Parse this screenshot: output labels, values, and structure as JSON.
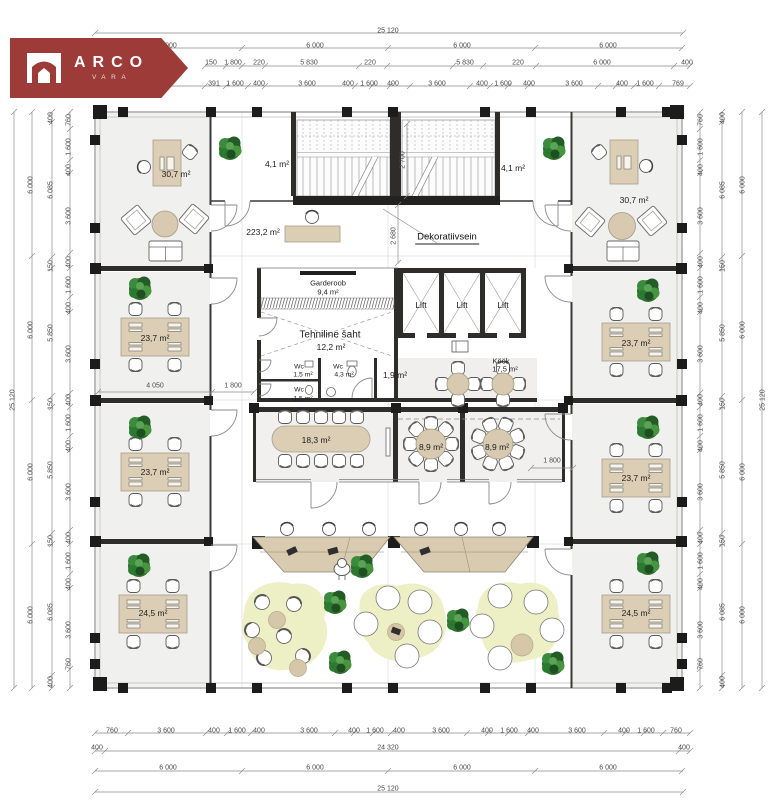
{
  "logo": {
    "brand": "ARCO",
    "sub": "VARA",
    "bg": "#9d3b38"
  },
  "rooms": {
    "office_tl": "30,7 m²",
    "office_tr": "30,7 m²",
    "vest_l": "4,1 m²",
    "vest_r": "4,1 m²",
    "open": "223,2 m²",
    "garderoob_name": "Garderoob",
    "garderoob_area": "9,4 m²",
    "shaft_name": "Tehniline šaht",
    "shaft_area": "12,2 m²",
    "lift": "Lift",
    "wc_name": "Wc",
    "wc1_area": "1,5 m²",
    "wc2_area": "1,5 m²",
    "wc3_area": "4,3 m²",
    "hall_area": "1,9 m²",
    "kitchen_name": "Köök",
    "kitchen_area": "17,5 m²",
    "decor": "Dekoratiivsein",
    "meeting_l": "18,3 m²",
    "meeting_m": "8,9 m²",
    "meeting_r": "8,9 m²",
    "office_l1": "23,7 m²",
    "office_l2": "23,7 m²",
    "office_l3": "24,5 m²",
    "office_r1": "23,7 m²",
    "office_r2": "23,7 m²",
    "office_r3": "24,5 m²"
  },
  "dims": {
    "top_total": "25 120",
    "top_bays": [
      "6 000",
      "6 000",
      "6 000",
      "6 000"
    ],
    "top_r3": [
      "150",
      "1 800",
      "220",
      "5 830",
      "220",
      "5 830",
      "220",
      "6 000",
      "400"
    ],
    "top_r4": [
      "391",
      "1 600",
      "400",
      "3 600",
      "400",
      "1 600",
      "400",
      "3 600",
      "400",
      "1 600",
      "400",
      "3 600",
      "400",
      "1 600",
      "769"
    ],
    "bottom_r1": [
      "760",
      "3 600",
      "400",
      "1 600",
      "400",
      "3 600",
      "400",
      "1 600",
      "400",
      "3 600",
      "400",
      "1 600",
      "400",
      "3 600",
      "400",
      "1 600",
      "760"
    ],
    "bottom_r2": [
      "400",
      "24 320",
      "400"
    ],
    "bottom_bays": [
      "6 000",
      "6 000",
      "6 000",
      "6 000"
    ],
    "bottom_total": "25 120",
    "left_total": "25 120",
    "left_bays": [
      "6 000",
      "6 000",
      "6 000",
      "6 000"
    ],
    "left_r3": [
      "400",
      "6 085",
      "150",
      "5 850",
      "150",
      "5 850",
      "150",
      "6 085",
      "400"
    ],
    "left_r4": [
      "760",
      "1 600",
      "400",
      "3 600",
      "400",
      "1 600",
      "400",
      "3 600",
      "400",
      "1 600",
      "400",
      "3 600",
      "400",
      "1 600",
      "400",
      "3 600",
      "760"
    ],
    "right_r4": [
      "760",
      "1 600",
      "400",
      "3 600",
      "400",
      "1 600",
      "400",
      "3 600",
      "400",
      "1 600",
      "400",
      "3 600",
      "400",
      "1 600",
      "400",
      "3 600",
      "760"
    ],
    "right_r3": [
      "400",
      "6 085",
      "150",
      "5 850",
      "150",
      "5 850",
      "150",
      "6 085",
      "400"
    ],
    "right_bays": [
      "6 000",
      "6 000",
      "6 000",
      "6 000"
    ],
    "right_total": "25 120",
    "int_corridor_a": "4 050",
    "int_corridor_b": "1 800",
    "int_meeting": "1 800",
    "int_stair_w": "2 700",
    "int_stair_h": "2 680"
  }
}
